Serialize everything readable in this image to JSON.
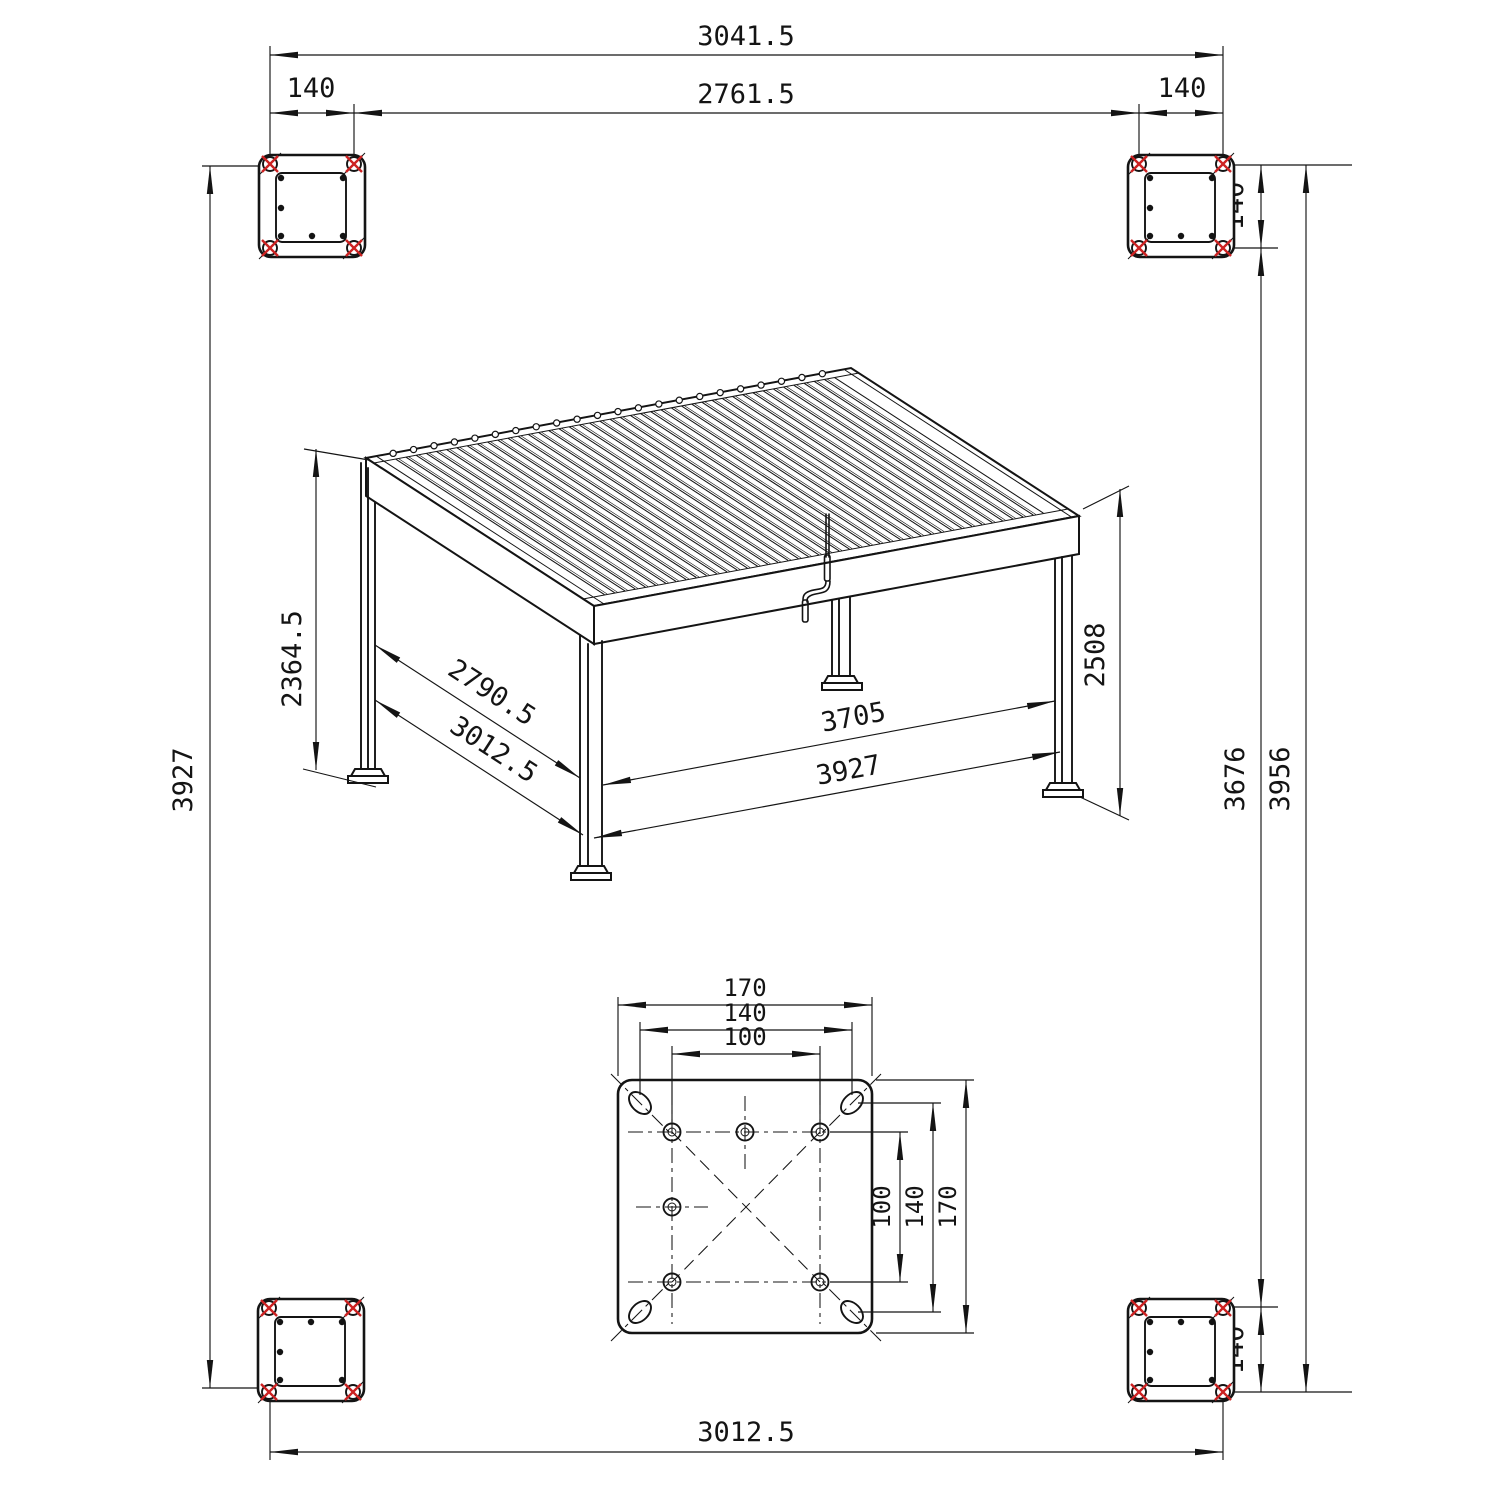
{
  "title": "Pergola anchoring dimension drawing",
  "colors": {
    "background": "#ffffff",
    "line": "#141414",
    "bolt_marker_red": "#cc2222"
  },
  "dims": {
    "top_outer_width": "3041.5",
    "top_inner_width": "2761.5",
    "plate_offset": "140",
    "left_height": "3927",
    "right_inner_height": "3676",
    "right_outer_height": "3956",
    "bottom_width": "3012.5",
    "post_height": "2364.5",
    "overall_height": "2508",
    "depth_inner": "2790.5",
    "depth_outer": "3012.5",
    "span_inner": "3705",
    "span_outer": "3927"
  },
  "plate_detail": {
    "size": "170",
    "slot_spacing": "140",
    "bolt_spacing": "100"
  }
}
